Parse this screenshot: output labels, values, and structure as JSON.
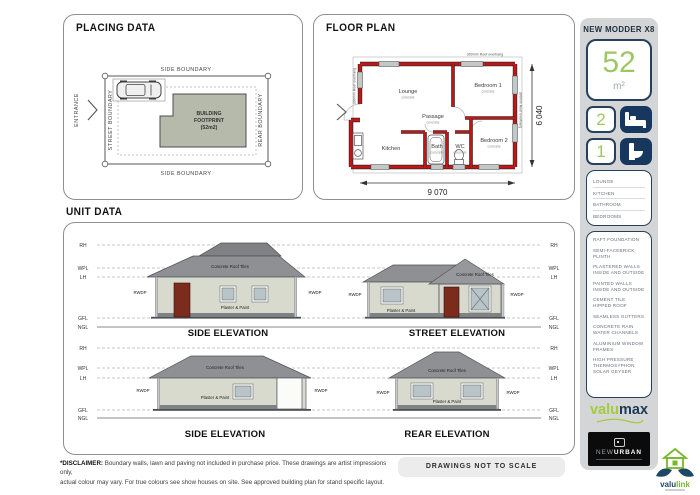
{
  "placing": {
    "title": "PLACING DATA",
    "entrance": "ENTRANCE",
    "side_boundary": "SIDE BOUNDARY",
    "street_boundary": "STREET BOUNDARY",
    "rear_boundary": "REAR BOUNDARY",
    "footprint": {
      "line1": "BUILDING",
      "line2": "FOOTPRINT",
      "line3": "(52m2)"
    }
  },
  "floor_plan": {
    "title": "FLOOR PLAN",
    "roof_overhang": "300mm Roof overhang",
    "dims": {
      "width": "9 070",
      "height": "6 040"
    },
    "rooms": {
      "lounge": {
        "name": "Lounge",
        "sub": "concrete"
      },
      "bedroom1": {
        "name": "Bedroom 1",
        "sub": "concrete"
      },
      "bedroom2": {
        "name": "Bedroom 2",
        "sub": "concrete"
      },
      "passage": {
        "name": "Passage",
        "sub": "concrete"
      },
      "kitchen": {
        "name": "Kitchen"
      },
      "bath": {
        "name": "Bath",
        "sub": "concrete"
      },
      "wc": {
        "name": "WC",
        "sub": "concrete"
      }
    }
  },
  "unit_data": {
    "title": "UNIT DATA",
    "levels": [
      "RH",
      "WPL",
      "LH",
      "GFL",
      "NGL"
    ],
    "labels": {
      "rwdp": "RWDP",
      "roof": "Concrete Roof Tiles",
      "wall": "Plaster & Paint"
    },
    "elevations": [
      {
        "caption": "SIDE ELEVATION"
      },
      {
        "caption": "STREET ELEVATION"
      },
      {
        "caption": "SIDE ELEVATION"
      },
      {
        "caption": "REAR ELEVATION"
      }
    ]
  },
  "sidebar": {
    "model_name": "NEW MODDER X8",
    "area": {
      "value": "52",
      "unit": "m²"
    },
    "bedrooms": "2",
    "bathrooms": "1",
    "rooms": [
      "LOUNGE",
      "KITCHEN",
      "BATHROOM",
      "BEDROOMS"
    ],
    "features": [
      "RAFT FOUNDATION",
      "SEMI-FACEBRICK PLINTH",
      "PLASTERED WALLS INSIDE AND OUTSIDE",
      "PAINTED WALLS INSIDE AND OUTSIDE",
      "CEMENT TILE HIPPED ROOF",
      "SEAMLESS GUTTERS",
      "CONCRETE RAIN WATER CHANNELS",
      "ALUMINIUM WINDOW FRAMES",
      "HIGH PRESSURE THERMOSYPHON SOLAR GEYSER"
    ]
  },
  "logos": {
    "valumax": {
      "part1": "valu",
      "part2": "max"
    },
    "new_urban": {
      "part1": "NEW",
      "part2": "URBAN"
    },
    "valulink": {
      "part1": "valu",
      "part2": "link"
    }
  },
  "footer": {
    "disclaimer_label": "*DISCLAIMER:",
    "disclaimer_line1": "Boundary walls, lawn and paving not included in purchase price. These drawings are artist impressions only,",
    "disclaimer_line2": "actual colour may vary. For true colours see show houses on site. See approved building plan for stand specific layout.",
    "scale_note": "DRAWINGS NOT TO SCALE"
  },
  "colors": {
    "accent_green": "#9cc863",
    "navy": "#17375e",
    "wall_red": "#c41414",
    "roof_gray": "#8e9093",
    "panel_gray": "#d4d5d7"
  }
}
